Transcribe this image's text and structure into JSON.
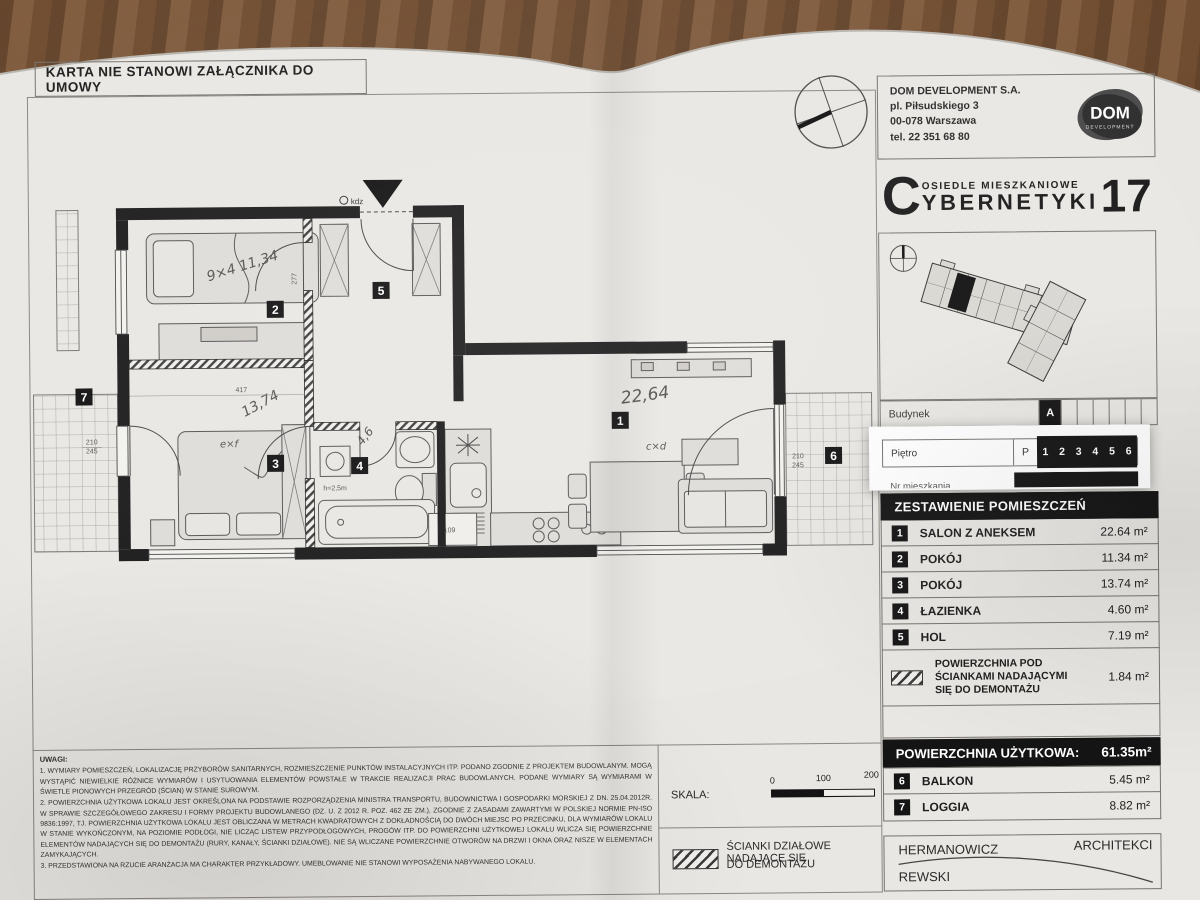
{
  "header": {
    "disclaimer": "KARTA NIE STANOWI ZAŁĄCZNIKA DO UMOWY"
  },
  "company": {
    "name": "DOM DEVELOPMENT S.A.",
    "address_line1": "pl. Piłsudskiego 3",
    "address_line2": "00-078 Warszawa",
    "phone": "tel. 22 351 68 80",
    "logo_text": "DOM",
    "logo_sub": "DEVELOPMENT"
  },
  "brand": {
    "estate": "OSIEDLE MIESZKANIOWE",
    "initial": "C",
    "name_rest": "YBERNETYKI",
    "number": "17"
  },
  "location": {
    "building_label": "Budynek",
    "building_value": "A",
    "floor_label": "Piętro",
    "floor_prefix": "P",
    "floors": [
      "1",
      "2",
      "3",
      "4",
      "5",
      "6"
    ],
    "apartment_label": "Nr mieszkania"
  },
  "rooms": {
    "title": "ZESTAWIENIE POMIESZCZEŃ",
    "items": [
      {
        "num": "1",
        "name": "SALON Z ANEKSEM",
        "area": "22.64 m²"
      },
      {
        "num": "2",
        "name": "POKÓJ",
        "area": "11.34 m²"
      },
      {
        "num": "3",
        "name": "POKÓJ",
        "area": "13.74 m²"
      },
      {
        "num": "4",
        "name": "ŁAZIENKA",
        "area": "4.60 m²"
      },
      {
        "num": "5",
        "name": "HOL",
        "area": "7.19 m²"
      }
    ],
    "demolition": {
      "line1": "POWIERZCHNIA POD",
      "line2": "ŚCIANKAMI NADAJĄCYMI",
      "line3": "SIĘ DO DEMONTAŻU",
      "area": "1.84 m²"
    }
  },
  "usable_area": {
    "label": "POWIERZCHNIA UŻYTKOWA:",
    "value": "61.35m²",
    "extras": [
      {
        "num": "6",
        "name": "BALKON",
        "area": "5.45 m²"
      },
      {
        "num": "7",
        "name": "LOGGIA",
        "area": "8.82 m²"
      }
    ]
  },
  "architect": {
    "name1": "HERMANOWICZ",
    "title": "ARCHITEKCI",
    "name2": "REWSKI"
  },
  "scale": {
    "label": "SKALA:",
    "tick0": "0",
    "tick100": "100",
    "tick200": "200"
  },
  "legend": {
    "line1": "ŚCIANKI DZIAŁOWE NADAJĄCE SIĘ",
    "line2": "DO DEMONTAŻU"
  },
  "notes": {
    "title": "UWAGI:",
    "item1": "1. WYMIARY POMIESZCZEŃ, LOKALIZACJĘ PRZYBORÓW SANITARNYCH, ROZMIESZCZENIE PUNKTÓW INSTALACYJNYCH ITP. PODANO ZGODNIE Z PROJEKTEM BUDOWLANYM. MOGĄ WYSTĄPIĆ NIEWIELKIE RÓŻNICE WYMIARÓW I USYTUOWANIA ELEMENTÓW POWSTAŁE W TRAKCIE REALIZACJI PRAC BUDOWLANYCH. PODANE WYMIARY SĄ WYMIARAMI W ŚWIETLE PIONOWYCH PRZEGRÓD (ŚCIAN) W STANIE SUROWYM.",
    "item2": "2. POWIERZCHNIA UŻYTKOWA LOKALU JEST OKREŚLONA NA PODSTAWIE ROZPORZĄDZENIA MINISTRA TRANSPORTU, BUDOWNICTWA I GOSPODARKI MORSKIEJ Z DN. 25.04.2012R. W SPRAWIE SZCZEGÓŁOWEGO ZAKRESU I FORMY PROJEKTU BUDOWLANEGO (DZ. U. Z 2012 R. POZ. 462 ZE ZM.), ZGODNIE Z ZASADAMI ZAWARTYMI W POLSKIEJ NORMIE PN-ISO 9836:1997, TJ. POWIERZCHNIA UŻYTKOWA LOKALU JEST OBLICZANA W METRACH KWADRATOWYCH Z DOKŁADNOŚCIĄ DO DWÓCH MIEJSC PO PRZECINKU, DLA WYMIARÓW LOKALU W STANIE WYKOŃCZONYM, NA POZIOMIE PODŁOGI, NIE LICZĄC LISTEW PRZYPODŁOGOWYCH, PROGÓW ITP. DO POWIERZCHNI UŻYTKOWEJ LOKALU WLICZA SIĘ POWIERZCHNIE ELEMENTÓW NADAJĄCYCH SIĘ DO DEMONTAŻU (RURY, KANAŁY, ŚCIANKI DZIAŁOWE). NIE SĄ WLICZANE POWIERZCHNIE OTWORÓW NA DRZWI I OKNA ORAZ NISZE W ELEMENTACH ZAMYKAJĄCYCH.",
    "item3": "3. PRZEDSTAWIONA NA RZUCIE ARANŻACJA MA CHARAKTER PRZYKŁADOWY. UMEBLOWANIE NIE STANOWI WYPOSAŻENIA NABYWANEGO LOKALU."
  },
  "plan": {
    "badges": {
      "salon": "1",
      "room2": "2",
      "room3": "3",
      "bathroom": "4",
      "hall": "5",
      "balcony": "6",
      "loggia": "7"
    },
    "handwritten": {
      "salon": "22,64",
      "room2": "9×4 11,34",
      "room3": "13,74",
      "bathroom": "4,6"
    },
    "marks": {
      "room3": "e×f",
      "salon": "c×d"
    },
    "dims": {
      "d417": "417",
      "d277": "277",
      "d210": "210",
      "d245": "245",
      "d210b": "210",
      "d245b": "245",
      "d109": "109",
      "height": "h=2,5m",
      "entrance": "kdz"
    }
  }
}
